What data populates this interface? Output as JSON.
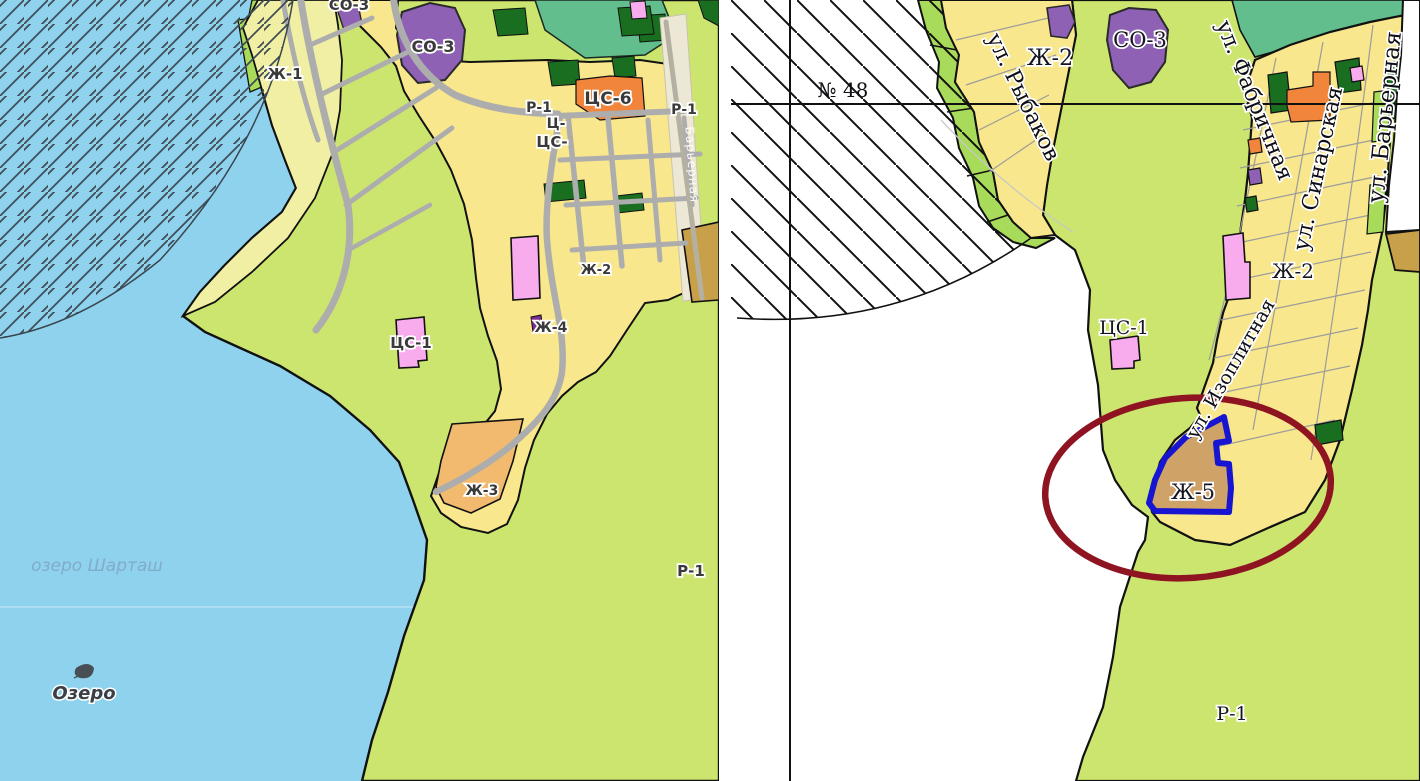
{
  "document_kind": "zoning-map-comparison",
  "left_map": {
    "labels": {
      "so3_top": "СО-3",
      "zh1": "Ж-1",
      "so3": "СО-3",
      "r1_upper": "Р-1",
      "ts_cut": "Ц-",
      "tss_cut": "ЦС-",
      "tss6": "ЦС-6",
      "r1_edge": "Р-1",
      "zh2": "Ж-2",
      "zh4": "Ж-4",
      "tss1": "ЦС-1",
      "zh3": "Ж-3",
      "r1_south": "Р-1"
    },
    "lake": {
      "name": "озеро Шарташ",
      "caption": "Озеро"
    },
    "road_label": "Барьерная"
  },
  "right_map": {
    "circle_label": "№ 48",
    "labels": {
      "zh2_nw": "Ж-2",
      "so3": "СО-3",
      "tss1": "ЦС-1",
      "zh2": "Ж-2",
      "zh5": "Ж-5",
      "r1": "Р-1"
    },
    "streets": {
      "rybakov": "ул. Рыбаков",
      "fabrichnaya": "ул. Фабричная",
      "sinarskaya": "ул. Синарская",
      "barernaya": "ул. Барьерная",
      "izoplitnaya": "ул. Изоплитная"
    },
    "highlight": {
      "highlighted_zone": "Ж-5",
      "ellipse_color": "#8e1421",
      "parcel_outline_color": "#1715d2"
    }
  },
  "zone_fill_colors": {
    "Ж-1": "#f0efa3",
    "Ж-2": "#f8e78c",
    "Ж-3": "#f2ba6e",
    "Ж-5": "#cfa268",
    "СО-3": "#8e61b4",
    "ЦС-1": "#f8acee",
    "ЦС-6": "#f0853b",
    "Р-1": "#cce56f"
  },
  "colors": {
    "lake": "#8fd2ee",
    "green_recreation": "#cce56f",
    "forest_teal": "#63be8d",
    "light_green_strip": "#a9db5a",
    "dark_green": "#1a6e20",
    "tan_parcel": "#cfa268",
    "dark_tan": "#c8a04a",
    "beige_road": "#ece8d5",
    "road_gray": "#adadad",
    "boundary": "#111111",
    "hatch_left": "#3e4b55",
    "hatch_right": "#111111",
    "lake_label": "#82abc8"
  }
}
